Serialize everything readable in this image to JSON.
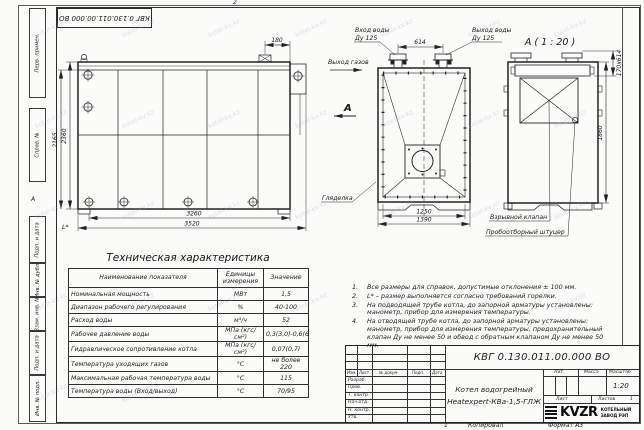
{
  "doc": {
    "number": "КВГ 0.130.011.00.000 ВО",
    "name_line1": "Котел водогрейный",
    "name_line2": "Heatexpert-КВа-1,5-ГЛЖ",
    "scale": "1:20",
    "lit_label": "Лит.",
    "mass_label": "Масса",
    "scale_label": "Масштаб",
    "sheet_label": "Лист",
    "sheets_label": "Листов",
    "sheets_value": "1",
    "copied": "Копировал",
    "format": "Формат А3",
    "zone_top": "2",
    "zone_bottom": "1",
    "zone_side": "А"
  },
  "logo": {
    "name": "KVZR",
    "line1": "КОТЕЛЬНЫЙ",
    "line2": "ЗАВОД РЭП"
  },
  "stamp": {
    "header": [
      "Изм.",
      "Лист",
      "№ докум.",
      "Подп.",
      "Дата"
    ],
    "rows": [
      "Разраб.",
      "Пров.",
      "Т. контр.",
      "Нач.отд.",
      "Н. контр.",
      "Утв."
    ]
  },
  "margin_labels": [
    "Перв. примен.",
    "Справ. №",
    "Подп. и дата",
    "Инв. № дубл.",
    "Взам. инв. №",
    "Подп. и дата",
    "Инв. № подл."
  ],
  "views": {
    "side": {
      "d180": "180",
      "d2165": "2165",
      "d2360": "2360",
      "d3260": "3260",
      "d3520": "3520",
      "lstar": "L*"
    },
    "front": {
      "inlet_l1": "Вход воды",
      "inlet_l2": "Ду 125",
      "outlet_l1": "Выход воды",
      "outlet_l2": "Ду 125",
      "gas": "Выход газов",
      "section": "А",
      "d614": "614",
      "sight": "Гляделка",
      "d1250": "1250",
      "d1390": "1390"
    },
    "detail": {
      "title": "А ( 1 : 20 )",
      "d170": "170х614",
      "d1860": "1860",
      "valve": "Взрывной клапан",
      "fitting": "Пробоотборный штуцер"
    }
  },
  "table": {
    "title": "Техническая характеристика",
    "headers": [
      "Наименование показателя",
      "Единицы измерения",
      "Значение"
    ],
    "rows": [
      [
        "Номинальная мощность",
        "МВт",
        "1,5"
      ],
      [
        "Диапазон рабочего регулирования",
        "%",
        "40-100"
      ],
      [
        "Расход воды",
        "м³/ч",
        "52"
      ],
      [
        "Рабочее давление воды",
        "МПа (кгс/см²)",
        "0,3(3,0)-0,6(6,0)"
      ],
      [
        "Гидравлическое сопротивление котла",
        "МПа (кгс/см²)",
        "0,07(0,7)"
      ],
      [
        "Температура уходящих газов",
        "°С",
        "не более 220"
      ],
      [
        "Максимальная рабочая температура воды",
        "°С",
        "115"
      ],
      [
        "Температура воды (Вход/выход)",
        "°С",
        "70/95"
      ]
    ]
  },
  "notes": [
    {
      "num": "1.",
      "text": "Все размеры для справок, допустимые отклонения ± 100 мм."
    },
    {
      "num": "2.",
      "text": "L* – размер выполняется согласно требований горелки."
    },
    {
      "num": "3.",
      "text": "На подводящей трубе котла, до запорной арматуры установлены: манометр, прибор для измерения температуры."
    },
    {
      "num": "4.",
      "text": "На отводящей трубе котла, до запорной арматуры установлены: манометр, прибор для измерения температуры, предохранительный клапан Ду не менее 50 и обвод с обратным клапаном Ду не менее 50 мм."
    }
  ],
  "watermark": {
    "text": "kotel-kv.kz"
  }
}
